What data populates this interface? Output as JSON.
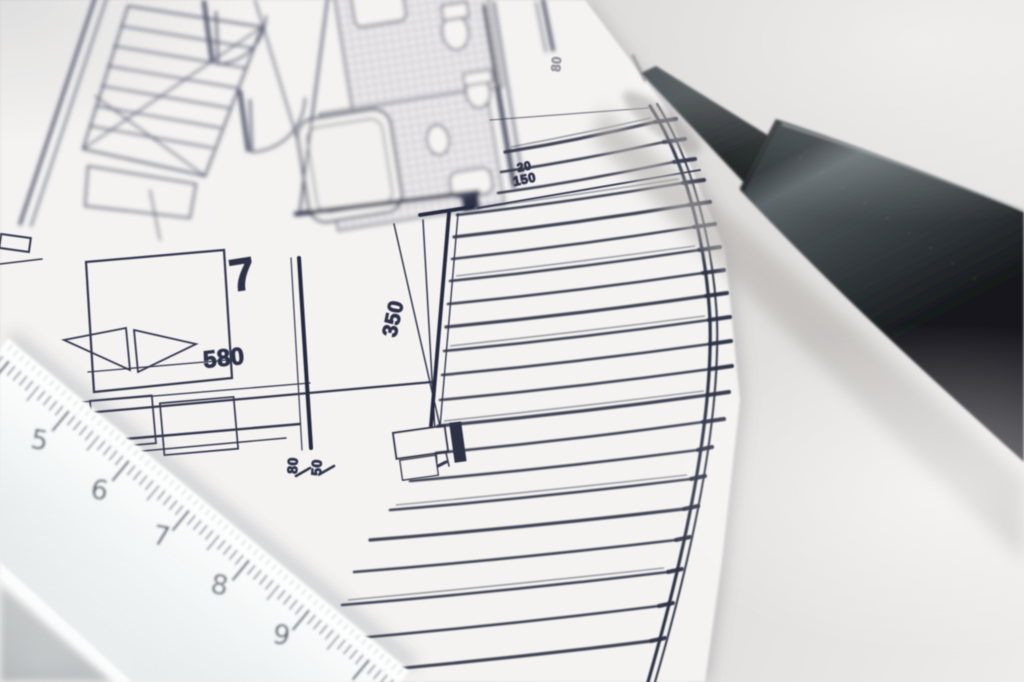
{
  "scene": {
    "title": "Architectural floor plan photograph with mechanical pencil and scale ruler",
    "colors": {
      "desk": "#dedcda",
      "paper": "#f4f3f1",
      "ink": "#383c50",
      "pencil_body": "#3c4245",
      "ruler_body": "#f5f7f6",
      "ruler_marks": "#464b60"
    }
  },
  "plan": {
    "room_number": "7",
    "dim_bed_width": "580",
    "dim_depth": "350",
    "dim_small_left": "80",
    "dim_small_right": "50",
    "dim_deck_top": "20",
    "dim_deck": "150",
    "dim_edge": "80"
  },
  "ruler": {
    "numbers": [
      "4",
      "5",
      "6",
      "7",
      "8",
      "9"
    ]
  }
}
